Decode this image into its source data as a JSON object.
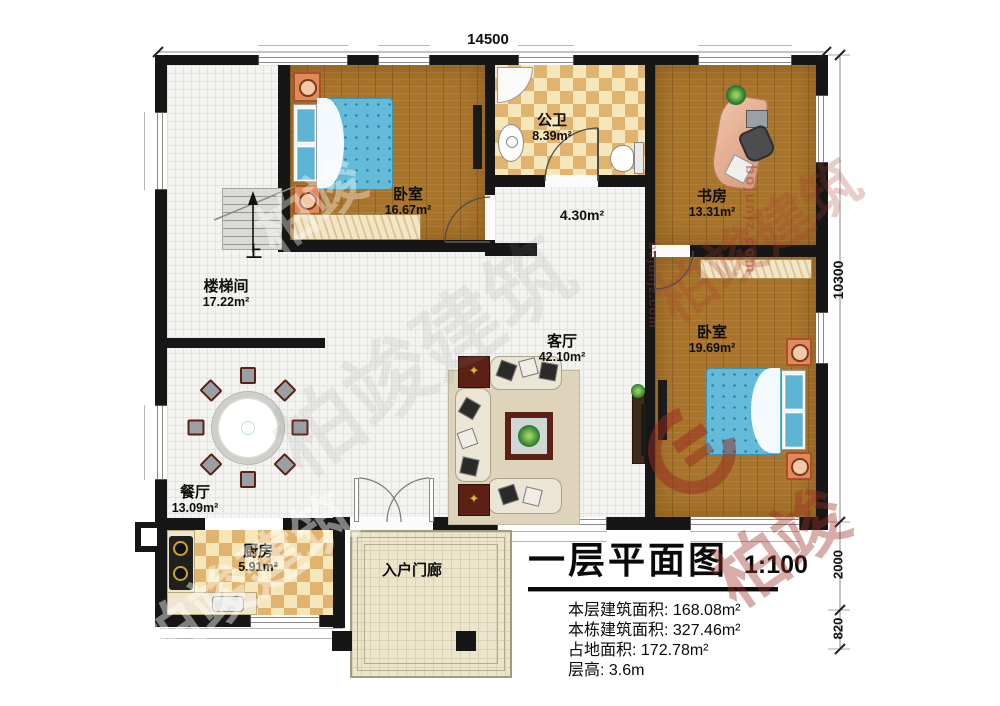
{
  "watermark": {
    "brand": "柏竣建筑",
    "brand_short": "柏竣",
    "site": "bojunjz.com"
  },
  "dimensions": {
    "top": "14500",
    "right_total": "10300",
    "right_porch": "2000",
    "right_step": "820"
  },
  "stairs": {
    "up": "上"
  },
  "rooms": {
    "bedroom1": {
      "name": "卧室",
      "area": "16.67m²"
    },
    "bathroom": {
      "name": "公卫",
      "area": "8.39m²"
    },
    "study": {
      "name": "书房",
      "area": "13.31m²"
    },
    "bedroom2": {
      "name": "卧室",
      "area": "19.69m²"
    },
    "living": {
      "name": "客厅",
      "area": "42.10m²"
    },
    "stairwell": {
      "name": "楼梯间",
      "area": "17.22m²"
    },
    "dining": {
      "name": "餐厅",
      "area": "13.09m²"
    },
    "kitchen": {
      "name": "厨房",
      "area": "5.91m²"
    },
    "corridor": {
      "area": "4.30m²"
    },
    "porch": {
      "name": "入户门廊"
    }
  },
  "title_block": {
    "title": "一层平面图",
    "scale": "1:100",
    "stats": [
      {
        "label": "本层建筑面积:",
        "value": "168.08m²"
      },
      {
        "label": "本栋建筑面积:",
        "value": "327.46m²"
      },
      {
        "label": "占地面积:",
        "value": "172.78m²"
      },
      {
        "label": "层高:",
        "value": "3.6m"
      }
    ]
  }
}
